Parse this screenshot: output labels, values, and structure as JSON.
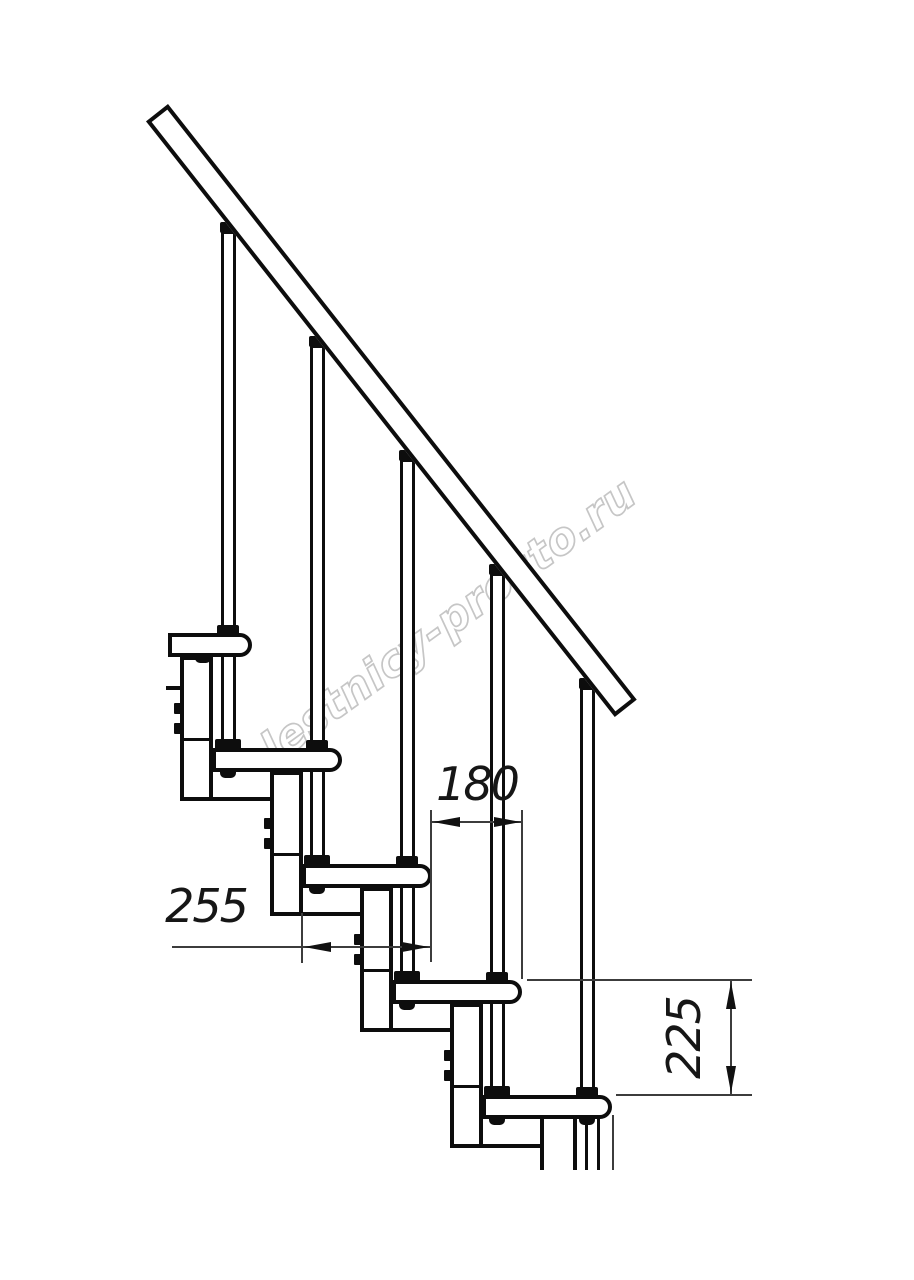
{
  "drawing": {
    "type": "staircase-side-view-technical-drawing",
    "watermark": {
      "text": "lestnicy-prosto.ru"
    },
    "dimensions": {
      "step_offset": {
        "value": "180"
      },
      "tread_depth": {
        "value": "255"
      },
      "step_height": {
        "value": "225"
      }
    },
    "colors": {
      "line": "#0d0d0d",
      "thin_line": "#3c3c3c",
      "watermark": "#c6c6c6",
      "background": "#ffffff"
    }
  }
}
